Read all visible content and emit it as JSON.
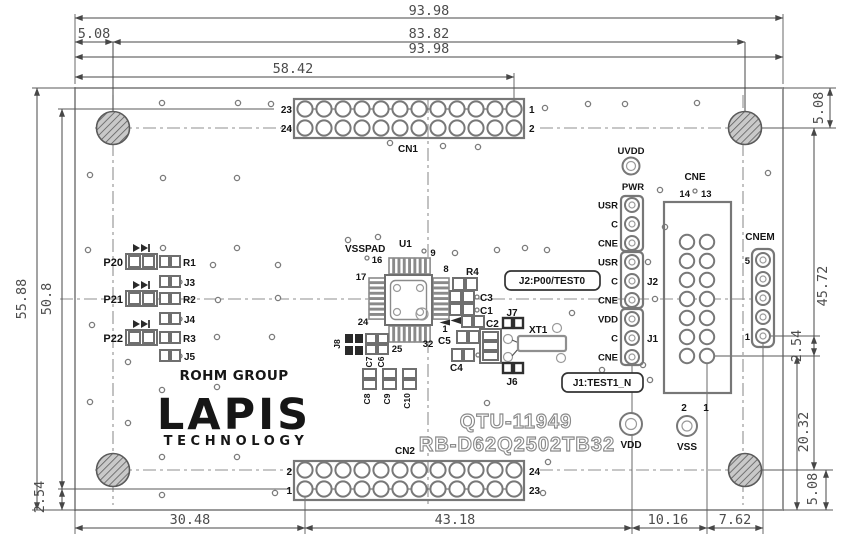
{
  "drawing": {
    "dim_top_width": "93.98",
    "dim_hole_offset": "5.08",
    "dim_hole_span": "83.82",
    "dim_top_width_2": "93.98",
    "dim_cn1_pin1": "58.42",
    "dim_left_height": "55.88",
    "dim_left_span": "50.8",
    "dim_left_pitch": "2.54",
    "dim_bottom_1": "30.48",
    "dim_bottom_2": "43.18",
    "dim_bottom_3": "10.16",
    "dim_bottom_4": "7.62",
    "dim_right_top_offset": "5.08",
    "dim_right_span": "45.72",
    "dim_right_cnem_pitch": "2.54",
    "dim_right_lower": "20.32",
    "dim_right_bottom_offset": "5.08"
  },
  "cn1": {
    "ref": "CN1",
    "pin_tl": "23",
    "pin_bl": "24",
    "pin_tr": "1",
    "pin_br": "2"
  },
  "cn2": {
    "ref": "CN2",
    "pin_tl": "2",
    "pin_bl": "1",
    "pin_tr": "24",
    "pin_br": "23"
  },
  "cne": {
    "ref": "CNE",
    "pin_14": "14",
    "pin_13": "13",
    "pin_2": "2",
    "pin_1": "1"
  },
  "cnem": {
    "ref": "CNEM",
    "pin_5": "5",
    "pin_1": "1"
  },
  "power_header": {
    "uvdd": "UVDD",
    "pwr": "PWR",
    "pins": [
      "USR",
      "C",
      "CNE",
      "USR",
      "C",
      "CNE",
      "VDD",
      "C",
      "CNE"
    ],
    "j2": "J2",
    "j1": "J1"
  },
  "test_pads": {
    "vdd": "VDD",
    "vss": "VSS"
  },
  "ic": {
    "ref": "U1",
    "vsspad": "VSSPAD",
    "pin16": "16",
    "pin9": "9",
    "pin17": "17",
    "pin8": "8",
    "pin24": "24",
    "pin25": "25",
    "pin1": "1",
    "pin32": "32"
  },
  "left_components": {
    "p20": "P20",
    "p21": "P21",
    "p22": "P22",
    "r1": "R1",
    "j3": "J3",
    "r2": "R2",
    "j4": "J4",
    "r3": "R3",
    "j5": "J5"
  },
  "center_components": {
    "r4": "R4",
    "c3": "C3",
    "c1": "C1",
    "c2": "C2",
    "c5": "C5",
    "c4": "C4",
    "j7": "J7",
    "j6": "J6",
    "xt1": "XT1",
    "j8": "J8",
    "c7": "C7",
    "c6": "C6",
    "c8": "C8",
    "c9": "C9",
    "c10": "C10"
  },
  "notes": {
    "j2": "J2:P00/TEST0",
    "j1": "J1:TEST1_N"
  },
  "branding": {
    "group": "ROHM GROUP",
    "logo": "LAPIS",
    "logo_sub": "TECHNOLOGY"
  },
  "titles": {
    "board": "QTU-11949",
    "part": "RB-D62Q2502TB32"
  }
}
